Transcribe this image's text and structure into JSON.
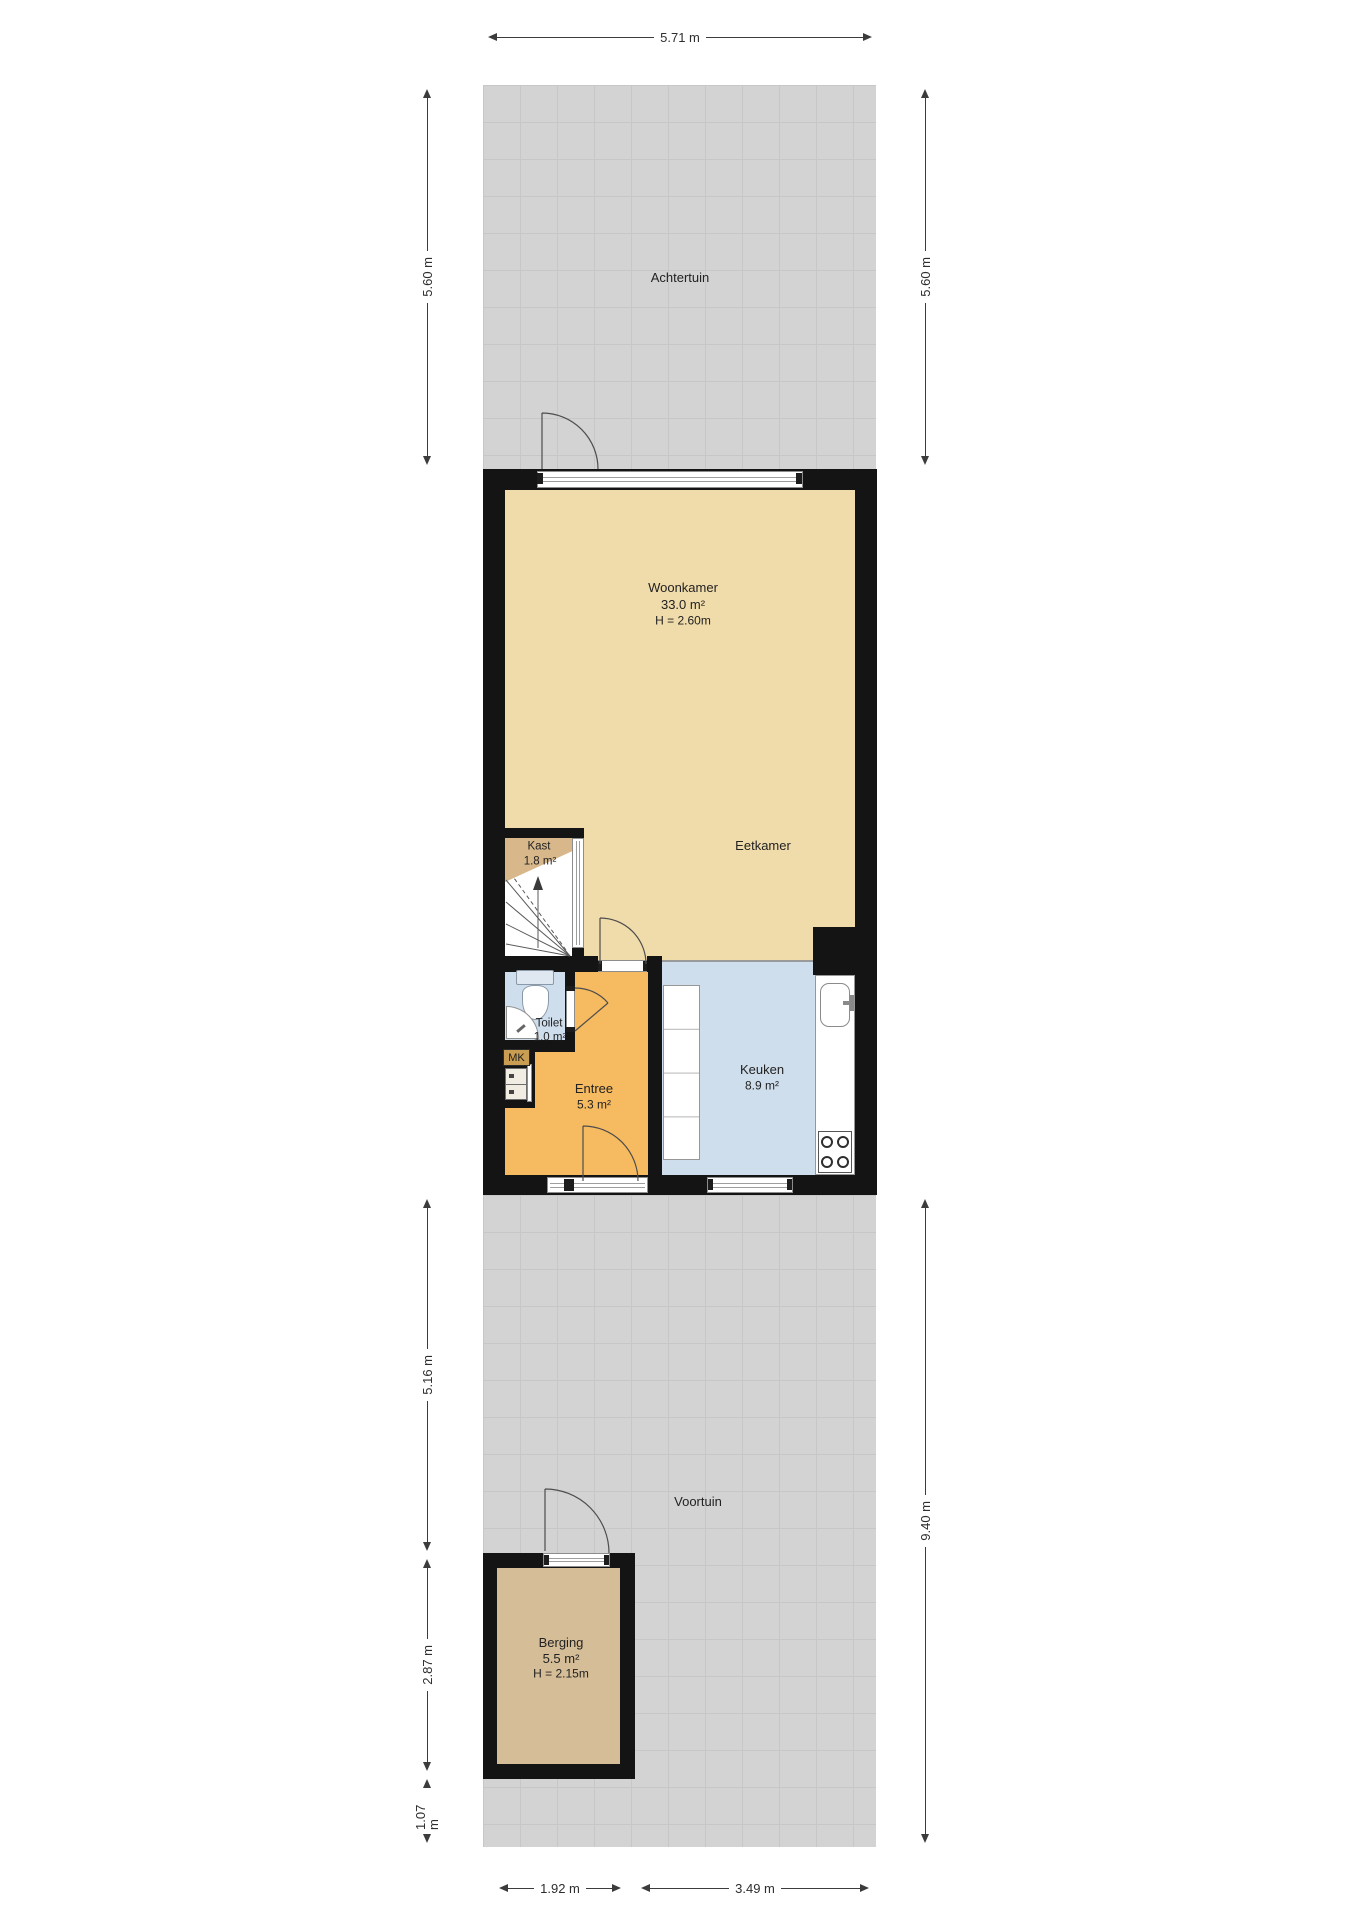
{
  "rooms": {
    "achtertuin": {
      "name": "Achtertuin"
    },
    "woonkamer": {
      "name": "Woonkamer",
      "area": "33.0 m²",
      "ceiling": "H = 2.60m"
    },
    "eetkamer": {
      "name": "Eetkamer"
    },
    "kast": {
      "name": "Kast",
      "area": "1.8 m²"
    },
    "toilet": {
      "name": "Toilet",
      "area": "1.0 m²"
    },
    "meterkast": {
      "name": "MK"
    },
    "entree": {
      "name": "Entree",
      "area": "5.3 m²"
    },
    "keuken": {
      "name": "Keuken",
      "area": "8.9 m²"
    },
    "voortuin": {
      "name": "Voortuin"
    },
    "berging": {
      "name": "Berging",
      "area": "5.5 m²",
      "ceiling": "H = 2.15m"
    }
  },
  "dimensions": {
    "plot_width_top": "5.71 m",
    "achtertuin_depth_left": "5.60 m",
    "achtertuin_depth_right": "5.60 m",
    "voortuin_depth_right": "9.40 m",
    "house_to_berging_left": "5.16 m",
    "berging_depth_left": "2.87 m",
    "berging_to_edge_left": "1.07 m",
    "berging_width_bottom": "1.92 m",
    "remaining_width_bottom": "3.49 m"
  },
  "colors": {
    "wall": "#141414",
    "garden": "#d3d3d3",
    "woonkamer": "#f0dbaa",
    "kast": "#d8b88b",
    "entree": "#f6ba60",
    "keuken": "#cfdeec",
    "toilet": "#cfdeec",
    "berging": "#d5bd97"
  }
}
